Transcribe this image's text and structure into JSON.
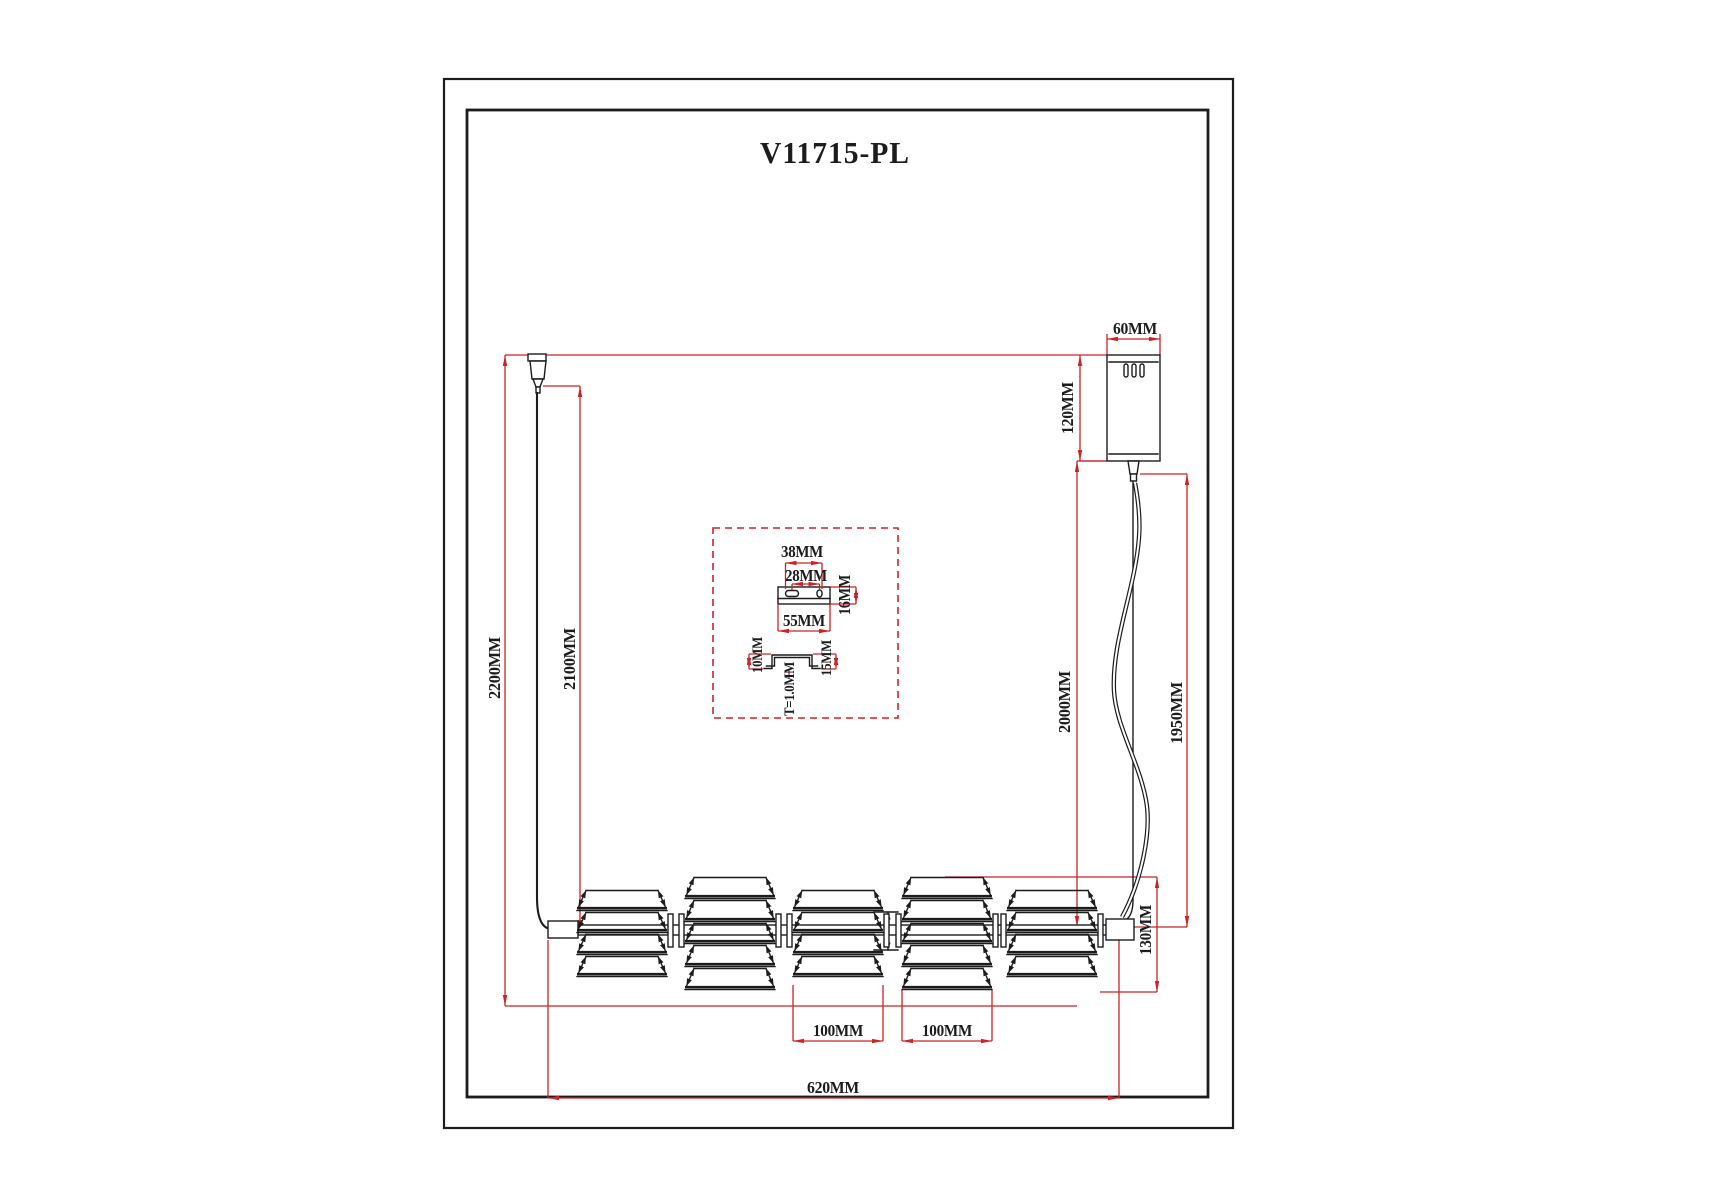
{
  "page": {
    "title": "V11715-PL"
  },
  "colors": {
    "ink": "#1c1c1c",
    "dim": "#cd2327",
    "bg": "#ffffff"
  },
  "labels": {
    "canopy_width": "60MM",
    "canopy_height": "120MM",
    "left_overall_drop": "2200MM",
    "left_wire_drop": "2100MM",
    "right_cord_drop": "2000MM",
    "right_wire_drop": "1950MM",
    "shade3_width": "100MM",
    "shade4_width": "100MM",
    "bar_length": "620MM",
    "shade_height": "130MM",
    "shade_gap_dim": "38MM"
  },
  "inset": {
    "hole_span": "38MM",
    "hole_spacing": "28MM",
    "plate_depth": "16MM",
    "plate_length": "55MM",
    "channel_height": "10MM",
    "channel_width": "15MM",
    "wall_thickness": "T=1.0MM"
  }
}
